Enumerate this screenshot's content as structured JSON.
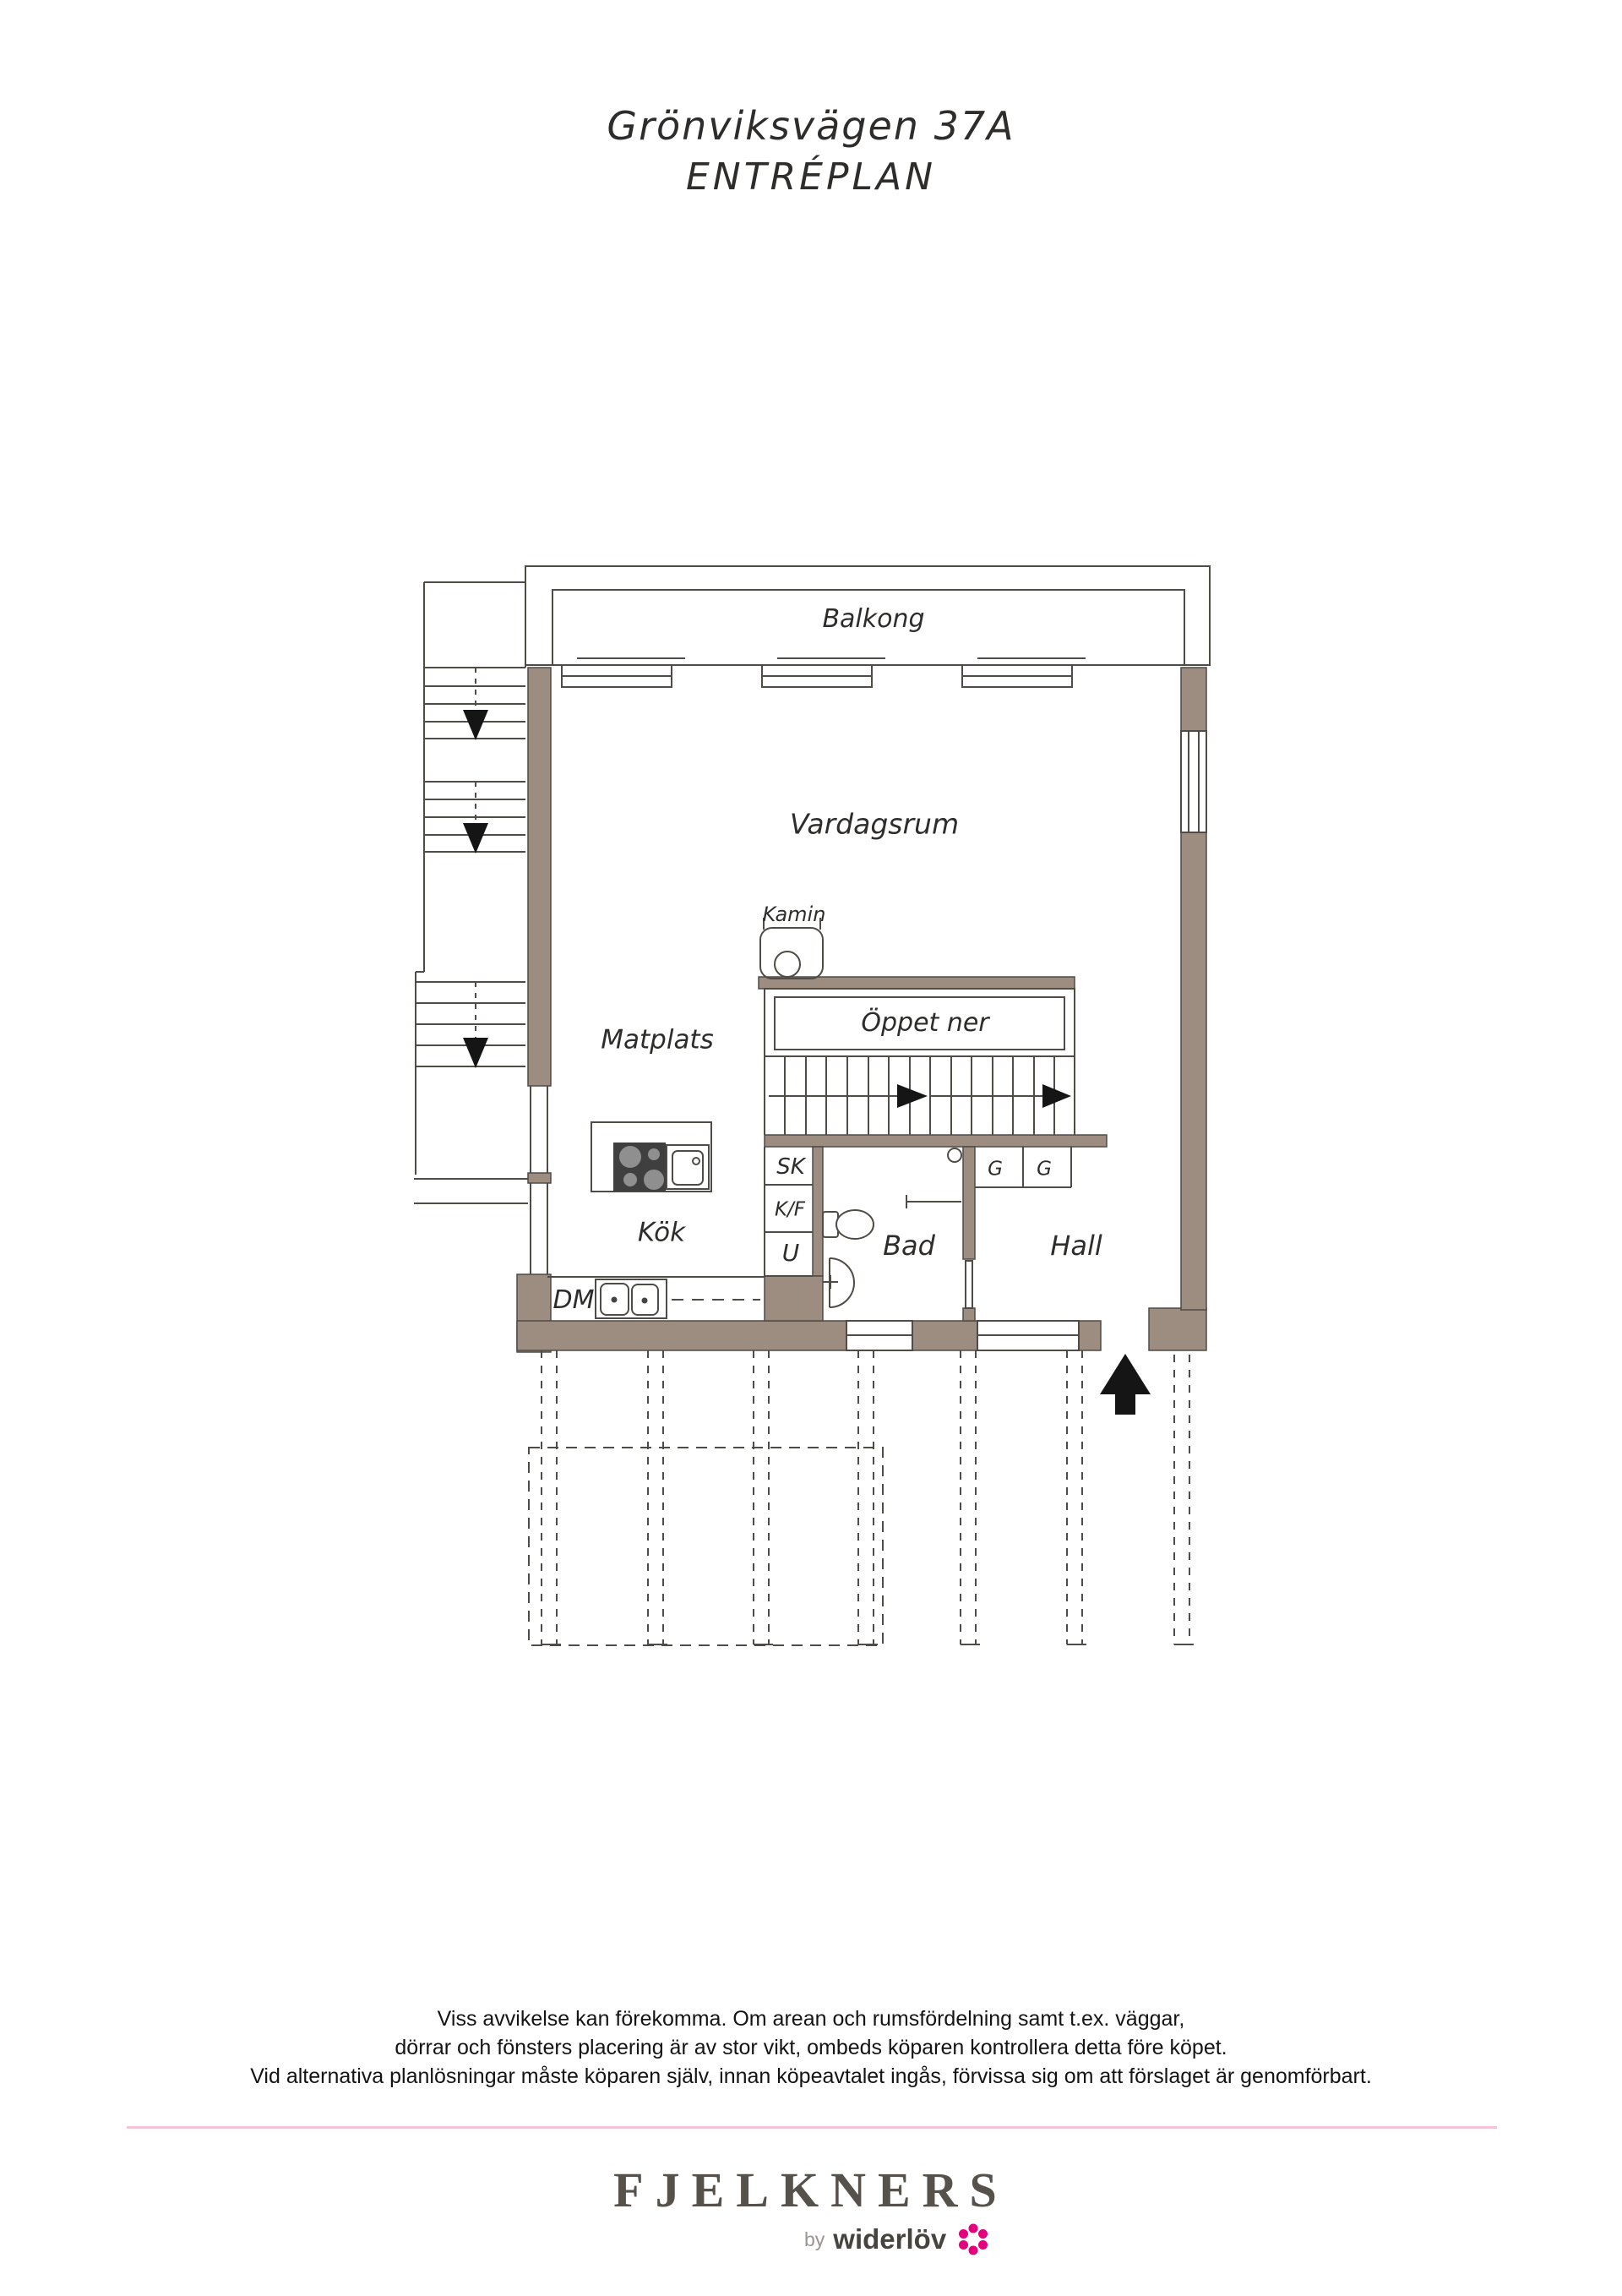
{
  "page": {
    "title_line1": "Grönviksvägen 37A",
    "title_line2": "ENTRÉPLAN"
  },
  "plan": {
    "rooms": {
      "balkong": "Balkong",
      "vardagsrum": "Vardagsrum",
      "kamin": "Kamin",
      "oppet_ner": "Öppet ner",
      "matplats": "Matplats",
      "kok": "Kök",
      "bad": "Bad",
      "hall": "Hall"
    },
    "fixtures": {
      "dm": "DM",
      "sk": "SK",
      "kf": "K/F",
      "u": "U",
      "g_left": "G",
      "g_right": "G"
    },
    "icons": {
      "stair_down_arrow": "black triangle pointing down",
      "stair_direction_arrow": "black triangle pointing right",
      "entrance_arrow": "black arrow pointing up at entry door",
      "fireplace": "rounded square with circle",
      "stove": "dark square with 4 burners",
      "kitchen_sink": "square basin with tap dot",
      "dishwasher_sinks": "double basin beside DM",
      "toilet": "tank and bowl",
      "washbasin": "half-round basin with tap cross",
      "flower": "widerlöv pink blossom"
    }
  },
  "disclaimer": {
    "line1": "Viss avvikelse kan förekomma. Om arean och rumsfördelning samt t.ex. väggar,",
    "line2": "dörrar och fönsters placering är av stor vikt, ombeds köparen kontrollera detta före köpet.",
    "line3": "Vid alternativa planlösningar måste köparen själv, innan köpeavtalet ingås, förvissa sig om att förslaget är genomförbart."
  },
  "footer": {
    "brand": "FJELKNERS",
    "byline_prefix": "by",
    "byline_brand": "widerlöv"
  },
  "colors": {
    "wall": "#9c8d80",
    "line": "#4f4b46",
    "arrow_black": "#151515",
    "divider_pink": "#f2c4d6",
    "flower_pink": "#e5007d",
    "logo_gray": "#57514b"
  }
}
